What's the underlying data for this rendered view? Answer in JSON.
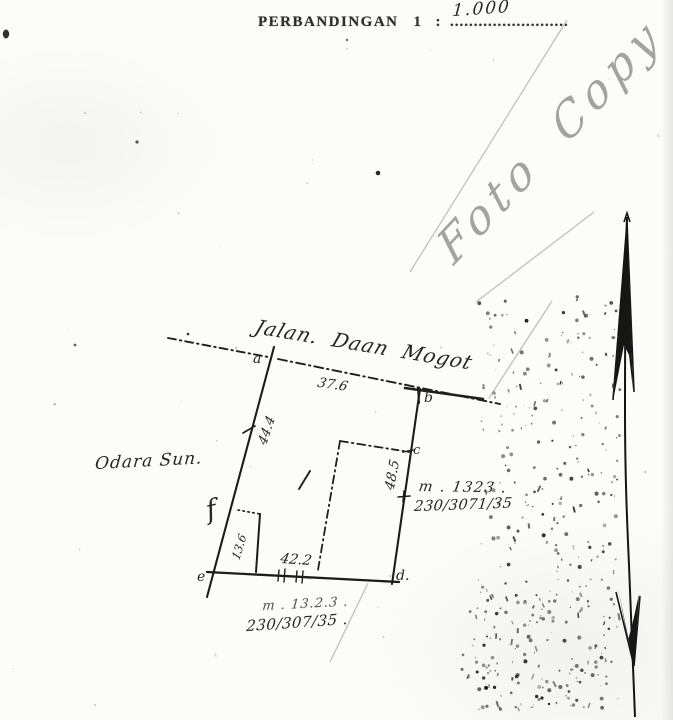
{
  "document": {
    "type_note": "scanned photocopy of a hand-drawn land survey sketch",
    "colors": {
      "ink": "#1f1f1f",
      "pencil": "#8d8d8d",
      "crease": "#c0c0c0",
      "paper": "#fcfcfb"
    },
    "header": {
      "scale_label": "PERBANDINGAN",
      "scale_number": "1",
      "colon": ":",
      "dotted_line": ".........................",
      "scale_value_handwritten": "1.000"
    },
    "watermark": "Foto Copy",
    "sketch": {
      "street_label": "Jalan. Daan Mogot",
      "west_neighbor_label": "Odara Sun.",
      "center_mark": "/",
      "measurements": {
        "road_frontage": "37.6",
        "west_side": "44.4",
        "east_side": "48.5",
        "south_side": "42.2",
        "notch": "13.6"
      },
      "corners": {
        "a": "a",
        "b": "b",
        "c": "c",
        "d": "d.",
        "e": "e",
        "f": "f"
      },
      "parcel_ref_east": {
        "line1": "m . 1323 .",
        "line2": "230/3071/35"
      },
      "parcel_ref_south": {
        "line1": "m . 13.2.3 .",
        "line2": "230/307/35 ."
      }
    }
  }
}
